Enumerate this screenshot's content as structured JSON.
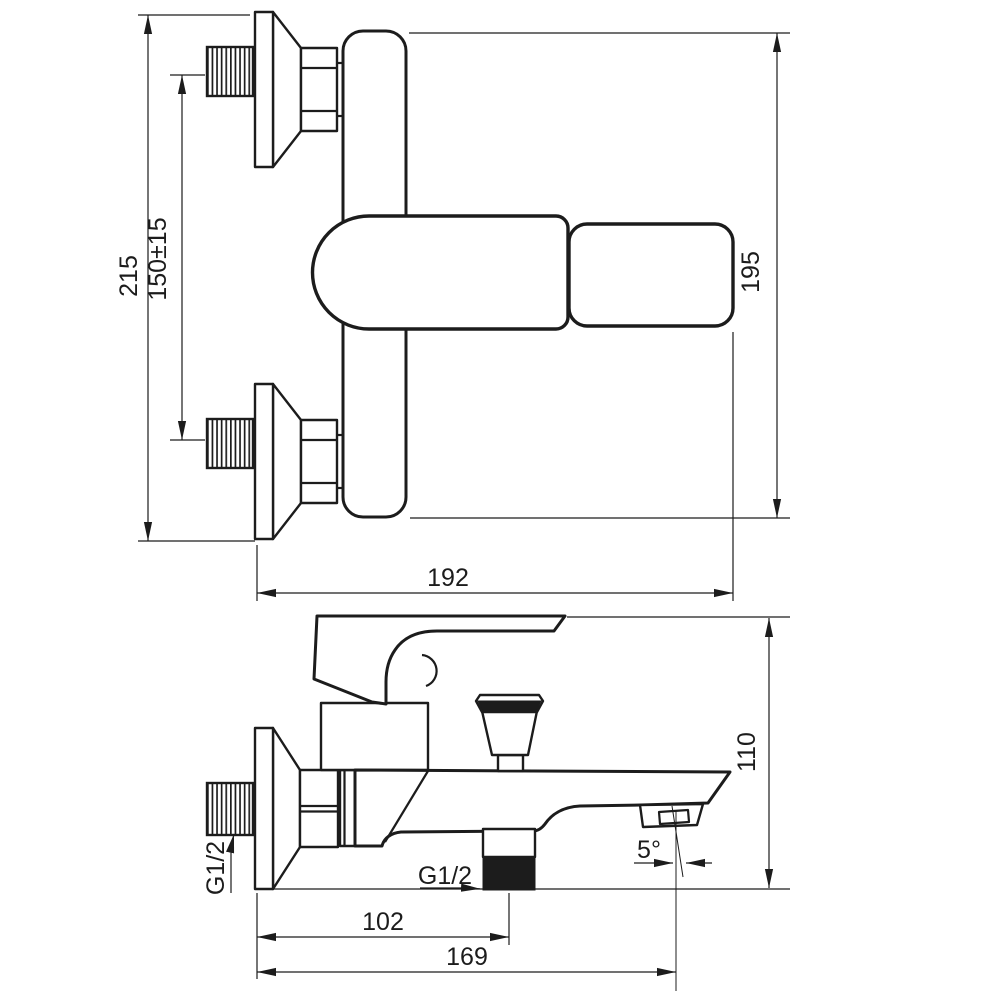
{
  "drawing": {
    "background": "#ffffff",
    "line_color": "#1c1c1c",
    "front_view": {
      "total_height": "215",
      "inlet_spacing": "150±15",
      "body_height": "195",
      "overall_width": "192"
    },
    "side_view": {
      "overall_depth": "110",
      "shower_outlet_distance": "102",
      "spout_reach": "169",
      "spout_angle": "5°",
      "wall_thread": "G1/2",
      "shower_thread": "G1/2"
    }
  }
}
